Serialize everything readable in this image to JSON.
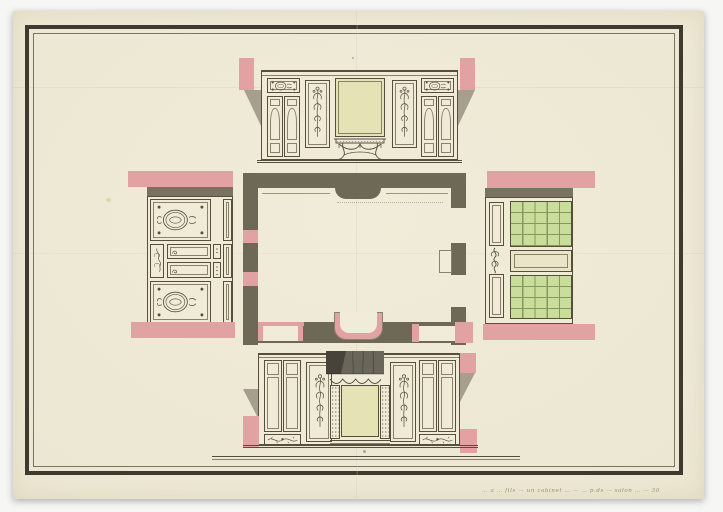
{
  "artwork": {
    "type": "architectural drawing",
    "subject": "Floor plan of a small paneled room (cabinet) with its four wall elevations folded out around the plan",
    "medium": "pen and ink with pink, olive, green and yellow watercolor wash on cream paper",
    "inscription": {
      "text": "… a … fils — un cabinet … — … p.ds — salon … — 30",
      "legibility": "faint handwritten pen note, largely illegible"
    },
    "palette": {
      "backdrop": "#f6f6f5",
      "backdrop_edge": "#dcdcdb",
      "paper": "#f0ecd9",
      "paper_mid": "#ece7d2",
      "paper_shade": "#e1dabf",
      "frame_dark": "#3e3a2f",
      "frame_inner": "#7a7363",
      "ink": "#554f3c",
      "ink_soft": "#8a8268",
      "panel_cream": "#efebd7",
      "poche": "#6e6857",
      "shadow_olive": "#8d8674",
      "pink": "#e2a2a2",
      "mirror": "#e5e3b6",
      "tablet": "#eae5c9",
      "window_green": "#c9de9a",
      "window_grid": "#87985f",
      "drapery": "#6b665a",
      "drapery_dark": "#47433a",
      "inscription_ink": "#8d7c55"
    },
    "parts": {
      "plan": "room floor plan with poched walls, door and window openings, bow-front console recess and chimney breast",
      "top_elevation": "wall with large central mirror over a console table, flanked by floral panels and double doors with medallion friezes",
      "bottom_elevation": "chimney wall with draped overmantel mirror, floral panels and paneled cupboard doors",
      "left_elevation": "paneled wall with two oval floral medallions and long horizontal panels (drawn folded outward)",
      "right_elevation": "window wall with two green trellised casements and a long panel between (drawn folded outward)",
      "scale_bar": "long double-ruled base line below the lower elevation",
      "frame": "dark double ink border ruled around the sheet"
    }
  }
}
